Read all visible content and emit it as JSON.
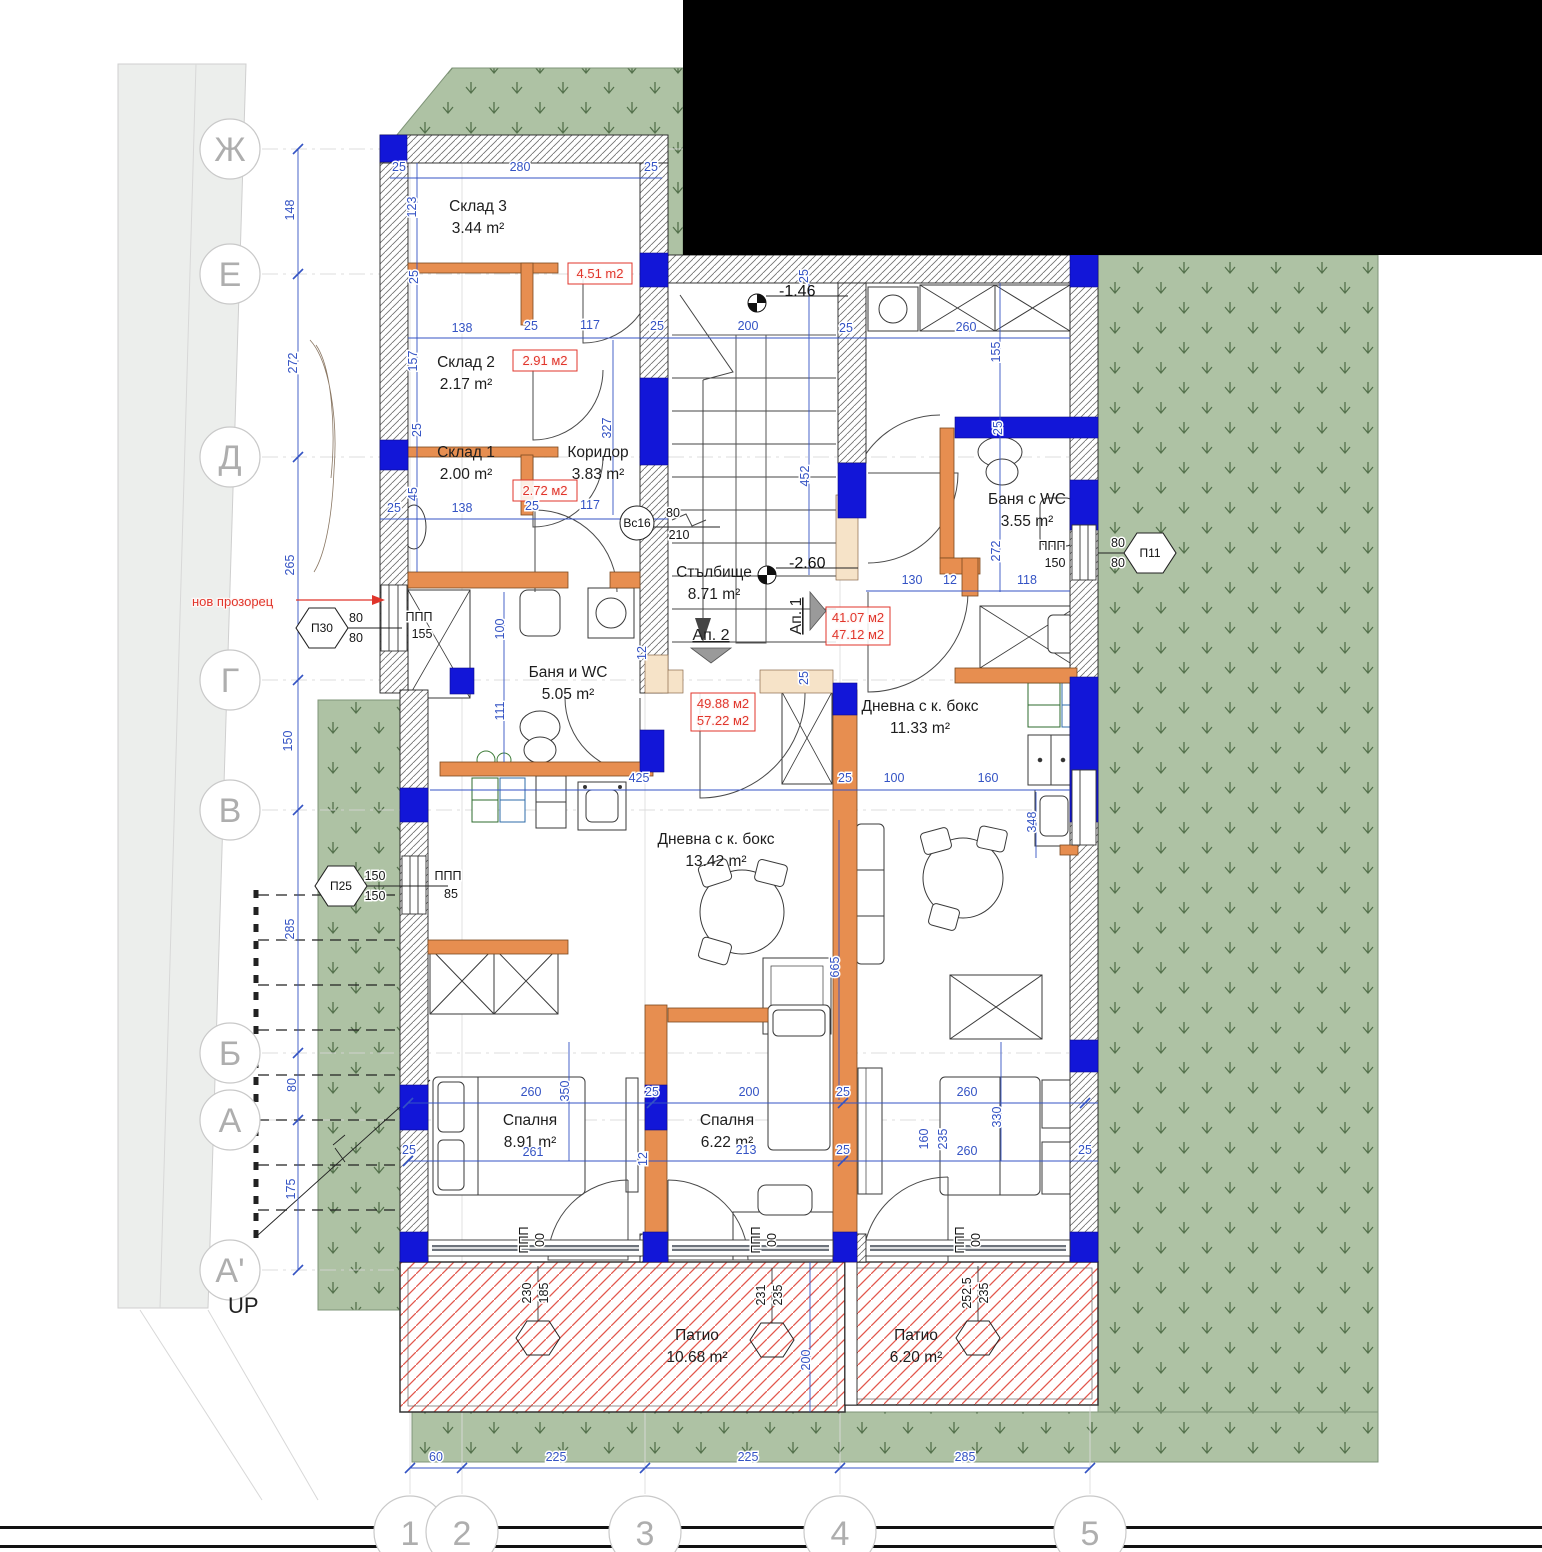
{
  "annotations": {
    "up_label": "UP",
    "new_window_note": "нов прозорец"
  },
  "rooms": [
    {
      "name": "Склад 3",
      "area": "3.44 m²",
      "x": 478,
      "y": 211
    },
    {
      "name": "Склад 2",
      "area": "2.17 m²",
      "x": 466,
      "y": 367
    },
    {
      "name": "Склад 1",
      "area": "2.00 m²",
      "x": 466,
      "y": 457
    },
    {
      "name": "Коридор",
      "area": "3.83 m²",
      "x": 598,
      "y": 457
    },
    {
      "name": "Стълбище",
      "area": "8.71 m²",
      "x": 714,
      "y": 577
    },
    {
      "name": "Баня и WC",
      "area": "5.05 m²",
      "x": 568,
      "y": 677
    },
    {
      "name": "Баня с WC",
      "area": "3.55 m²",
      "x": 1027,
      "y": 504
    },
    {
      "name": "Дневна с к. бокс",
      "area": "11.33 m²",
      "x": 920,
      "y": 711
    },
    {
      "name": "Дневна с к. бокс",
      "area": "13.42 m²",
      "x": 716,
      "y": 844
    },
    {
      "name": "Спалня",
      "area": "8.91 m²",
      "x": 530,
      "y": 1125
    },
    {
      "name": "Спалня",
      "area": "6.22 m²",
      "x": 727,
      "y": 1125
    },
    {
      "name": "Патио",
      "area": "10.68 m²",
      "x": 697,
      "y": 1340
    },
    {
      "name": "Патио",
      "area": "6.20 m²",
      "x": 916,
      "y": 1340
    }
  ],
  "red_notes": [
    {
      "lines": [
        "4.51 m2"
      ],
      "x": 600,
      "y": 278
    },
    {
      "lines": [
        "2.91 м2"
      ],
      "x": 545,
      "y": 365
    },
    {
      "lines": [
        "2.72 м2"
      ],
      "x": 545,
      "y": 495
    },
    {
      "lines": [
        "41.07 м2",
        "47.12 м2"
      ],
      "x": 858,
      "y": 622
    },
    {
      "lines": [
        "49.88 м2",
        "57.22 м2"
      ],
      "x": 723,
      "y": 708
    }
  ],
  "apartment_markers": [
    {
      "label": "Ап. 2",
      "x": 711,
      "y": 640,
      "rot": 0
    },
    {
      "label": "Ап. 1",
      "x": 801,
      "y": 616,
      "rot": 1
    }
  ],
  "elevations": [
    {
      "value": "-1.46",
      "x": 757,
      "y": 303
    },
    {
      "value": "-2.60",
      "x": 767,
      "y": 575
    }
  ],
  "axes": {
    "letters": [
      {
        "l": "Ж",
        "y": 149
      },
      {
        "l": "Е",
        "y": 274
      },
      {
        "l": "Д",
        "y": 457
      },
      {
        "l": "Г",
        "y": 680
      },
      {
        "l": "В",
        "y": 810
      },
      {
        "l": "Б",
        "y": 1053
      },
      {
        "l": "А",
        "y": 1120
      },
      {
        "l": "А'",
        "y": 1270
      }
    ],
    "numbers": [
      {
        "l": "1",
        "x": 410
      },
      {
        "l": "2",
        "x": 462
      },
      {
        "l": "3",
        "x": 645
      },
      {
        "l": "4",
        "x": 840
      },
      {
        "l": "5",
        "x": 1090
      }
    ]
  },
  "hex_markers": [
    {
      "label": "П30",
      "x": 322,
      "y": 628,
      "top": "80",
      "bottom": "80",
      "side": "right",
      "note": null
    },
    {
      "label": "П25",
      "x": 341,
      "y": 886,
      "top": "150",
      "bottom": "150",
      "side": "right",
      "note": [
        "ППП",
        "85"
      ]
    },
    {
      "label": "П11",
      "x": 1150,
      "y": 553,
      "top": "80",
      "bottom": "80",
      "side": "left",
      "note": null
    }
  ],
  "circle_marker": {
    "label": "Вс16",
    "x": 637,
    "y": 523,
    "top": "80",
    "bottom": "210"
  },
  "patio_hexes": [
    {
      "x": 538,
      "y": 1338,
      "a": "230",
      "b": "185"
    },
    {
      "x": 772,
      "y": 1340,
      "a": "231",
      "b": "235"
    },
    {
      "x": 978,
      "y": 1338,
      "a": "252.5",
      "b": "235"
    }
  ],
  "ppp_labels": [
    {
      "lines": [
        "ППП",
        "155"
      ],
      "x": 419,
      "y": 621,
      "rot": 0
    },
    {
      "lines": [
        "ППП",
        "150"
      ],
      "x": 1052,
      "y": 550,
      "rot": 0
    },
    {
      "lines": [
        "ППП",
        "00"
      ],
      "x": 536,
      "y": 1240,
      "rot": 1
    },
    {
      "lines": [
        "ППП",
        "00"
      ],
      "x": 768,
      "y": 1240,
      "rot": 1
    },
    {
      "lines": [
        "ППП",
        "00"
      ],
      "x": 972,
      "y": 1240,
      "rot": 1
    }
  ],
  "dimensions": [
    {
      "t": "280",
      "x": 520,
      "y": 171
    },
    {
      "t": "25",
      "x": 399,
      "y": 171
    },
    {
      "t": "25",
      "x": 651,
      "y": 171
    },
    {
      "t": "123",
      "x": 416,
      "y": 207,
      "r": 1
    },
    {
      "t": "25",
      "x": 418,
      "y": 277,
      "r": 1
    },
    {
      "t": "148",
      "x": 294,
      "y": 210,
      "r": 1
    },
    {
      "t": "138",
      "x": 462,
      "y": 332
    },
    {
      "t": "25",
      "x": 531,
      "y": 330
    },
    {
      "t": "117",
      "x": 590,
      "y": 329
    },
    {
      "t": "157",
      "x": 417,
      "y": 361,
      "r": 1
    },
    {
      "t": "272",
      "x": 297,
      "y": 363,
      "r": 1
    },
    {
      "t": "45",
      "x": 417,
      "y": 494,
      "r": 1
    },
    {
      "t": "138",
      "x": 462,
      "y": 512
    },
    {
      "t": "25",
      "x": 532,
      "y": 510
    },
    {
      "t": "117",
      "x": 590,
      "y": 509
    },
    {
      "t": "25",
      "x": 394,
      "y": 512
    },
    {
      "t": "327",
      "x": 611,
      "y": 428,
      "r": 1
    },
    {
      "t": "25",
      "x": 421,
      "y": 430,
      "r": 1
    },
    {
      "t": "25",
      "x": 657,
      "y": 330
    },
    {
      "t": "200",
      "x": 748,
      "y": 330
    },
    {
      "t": "25",
      "x": 808,
      "y": 276,
      "r": 1
    },
    {
      "t": "452",
      "x": 809,
      "y": 476,
      "r": 1
    },
    {
      "t": "25",
      "x": 846,
      "y": 332
    },
    {
      "t": "260",
      "x": 966,
      "y": 331
    },
    {
      "t": "155",
      "x": 1000,
      "y": 352,
      "r": 1
    },
    {
      "t": "272",
      "x": 1000,
      "y": 551,
      "r": 1
    },
    {
      "t": "25",
      "x": 1002,
      "y": 428,
      "r": 1
    },
    {
      "t": "130",
      "x": 912,
      "y": 584
    },
    {
      "t": "12",
      "x": 950,
      "y": 584
    },
    {
      "t": "118",
      "x": 1027,
      "y": 584
    },
    {
      "t": "265",
      "x": 294,
      "y": 565,
      "r": 1
    },
    {
      "t": "100",
      "x": 504,
      "y": 629,
      "r": 1
    },
    {
      "t": "111",
      "x": 504,
      "y": 711,
      "r": 1
    },
    {
      "t": "12",
      "x": 646,
      "y": 653,
      "r": 1
    },
    {
      "t": "150",
      "x": 292,
      "y": 741,
      "r": 1
    },
    {
      "t": "425",
      "x": 639,
      "y": 782
    },
    {
      "t": "25",
      "x": 845,
      "y": 782
    },
    {
      "t": "100",
      "x": 894,
      "y": 782
    },
    {
      "t": "160",
      "x": 988,
      "y": 782
    },
    {
      "t": "348",
      "x": 1036,
      "y": 822,
      "r": 1
    },
    {
      "t": "25",
      "x": 808,
      "y": 678,
      "r": 1
    },
    {
      "t": "285",
      "x": 294,
      "y": 929,
      "r": 1
    },
    {
      "t": "665",
      "x": 839,
      "y": 967,
      "r": 1
    },
    {
      "t": "80",
      "x": 296,
      "y": 1085,
      "r": 1
    },
    {
      "t": "175",
      "x": 295,
      "y": 1189,
      "r": 1
    },
    {
      "t": "350",
      "x": 569,
      "y": 1091,
      "r": 1
    },
    {
      "t": "260",
      "x": 531,
      "y": 1096
    },
    {
      "t": "261",
      "x": 533,
      "y": 1156
    },
    {
      "t": "25",
      "x": 652,
      "y": 1096
    },
    {
      "t": "12",
      "x": 647,
      "y": 1159,
      "r": 1
    },
    {
      "t": "200",
      "x": 749,
      "y": 1096
    },
    {
      "t": "213",
      "x": 746,
      "y": 1154
    },
    {
      "t": "25",
      "x": 843,
      "y": 1096
    },
    {
      "t": "25",
      "x": 843,
      "y": 1154
    },
    {
      "t": "160",
      "x": 928,
      "y": 1139,
      "r": 1
    },
    {
      "t": "235",
      "x": 947,
      "y": 1139,
      "r": 1
    },
    {
      "t": "260",
      "x": 967,
      "y": 1096
    },
    {
      "t": "260",
      "x": 967,
      "y": 1155
    },
    {
      "t": "330",
      "x": 1001,
      "y": 1117,
      "r": 1
    },
    {
      "t": "25",
      "x": 1085,
      "y": 1154
    },
    {
      "t": "25",
      "x": 409,
      "y": 1154
    },
    {
      "t": "200",
      "x": 810,
      "y": 1360,
      "r": 1
    },
    {
      "t": "60",
      "x": 436,
      "y": 1461
    },
    {
      "t": "225",
      "x": 556,
      "y": 1461
    },
    {
      "t": "225",
      "x": 748,
      "y": 1461
    },
    {
      "t": "285",
      "x": 965,
      "y": 1461
    }
  ],
  "colors": {
    "wall_blue": "#1216d8",
    "wall_orange": "#e78e50",
    "lintel_beige": "#f6e3c8",
    "grass_green": "#aec2a4",
    "grass_glyph": "#54714c",
    "dim_blue": "#3453c4",
    "red_note": "#e0352b",
    "patio_hatch": "#e2574c",
    "axis_gray": "#aeaeae"
  }
}
